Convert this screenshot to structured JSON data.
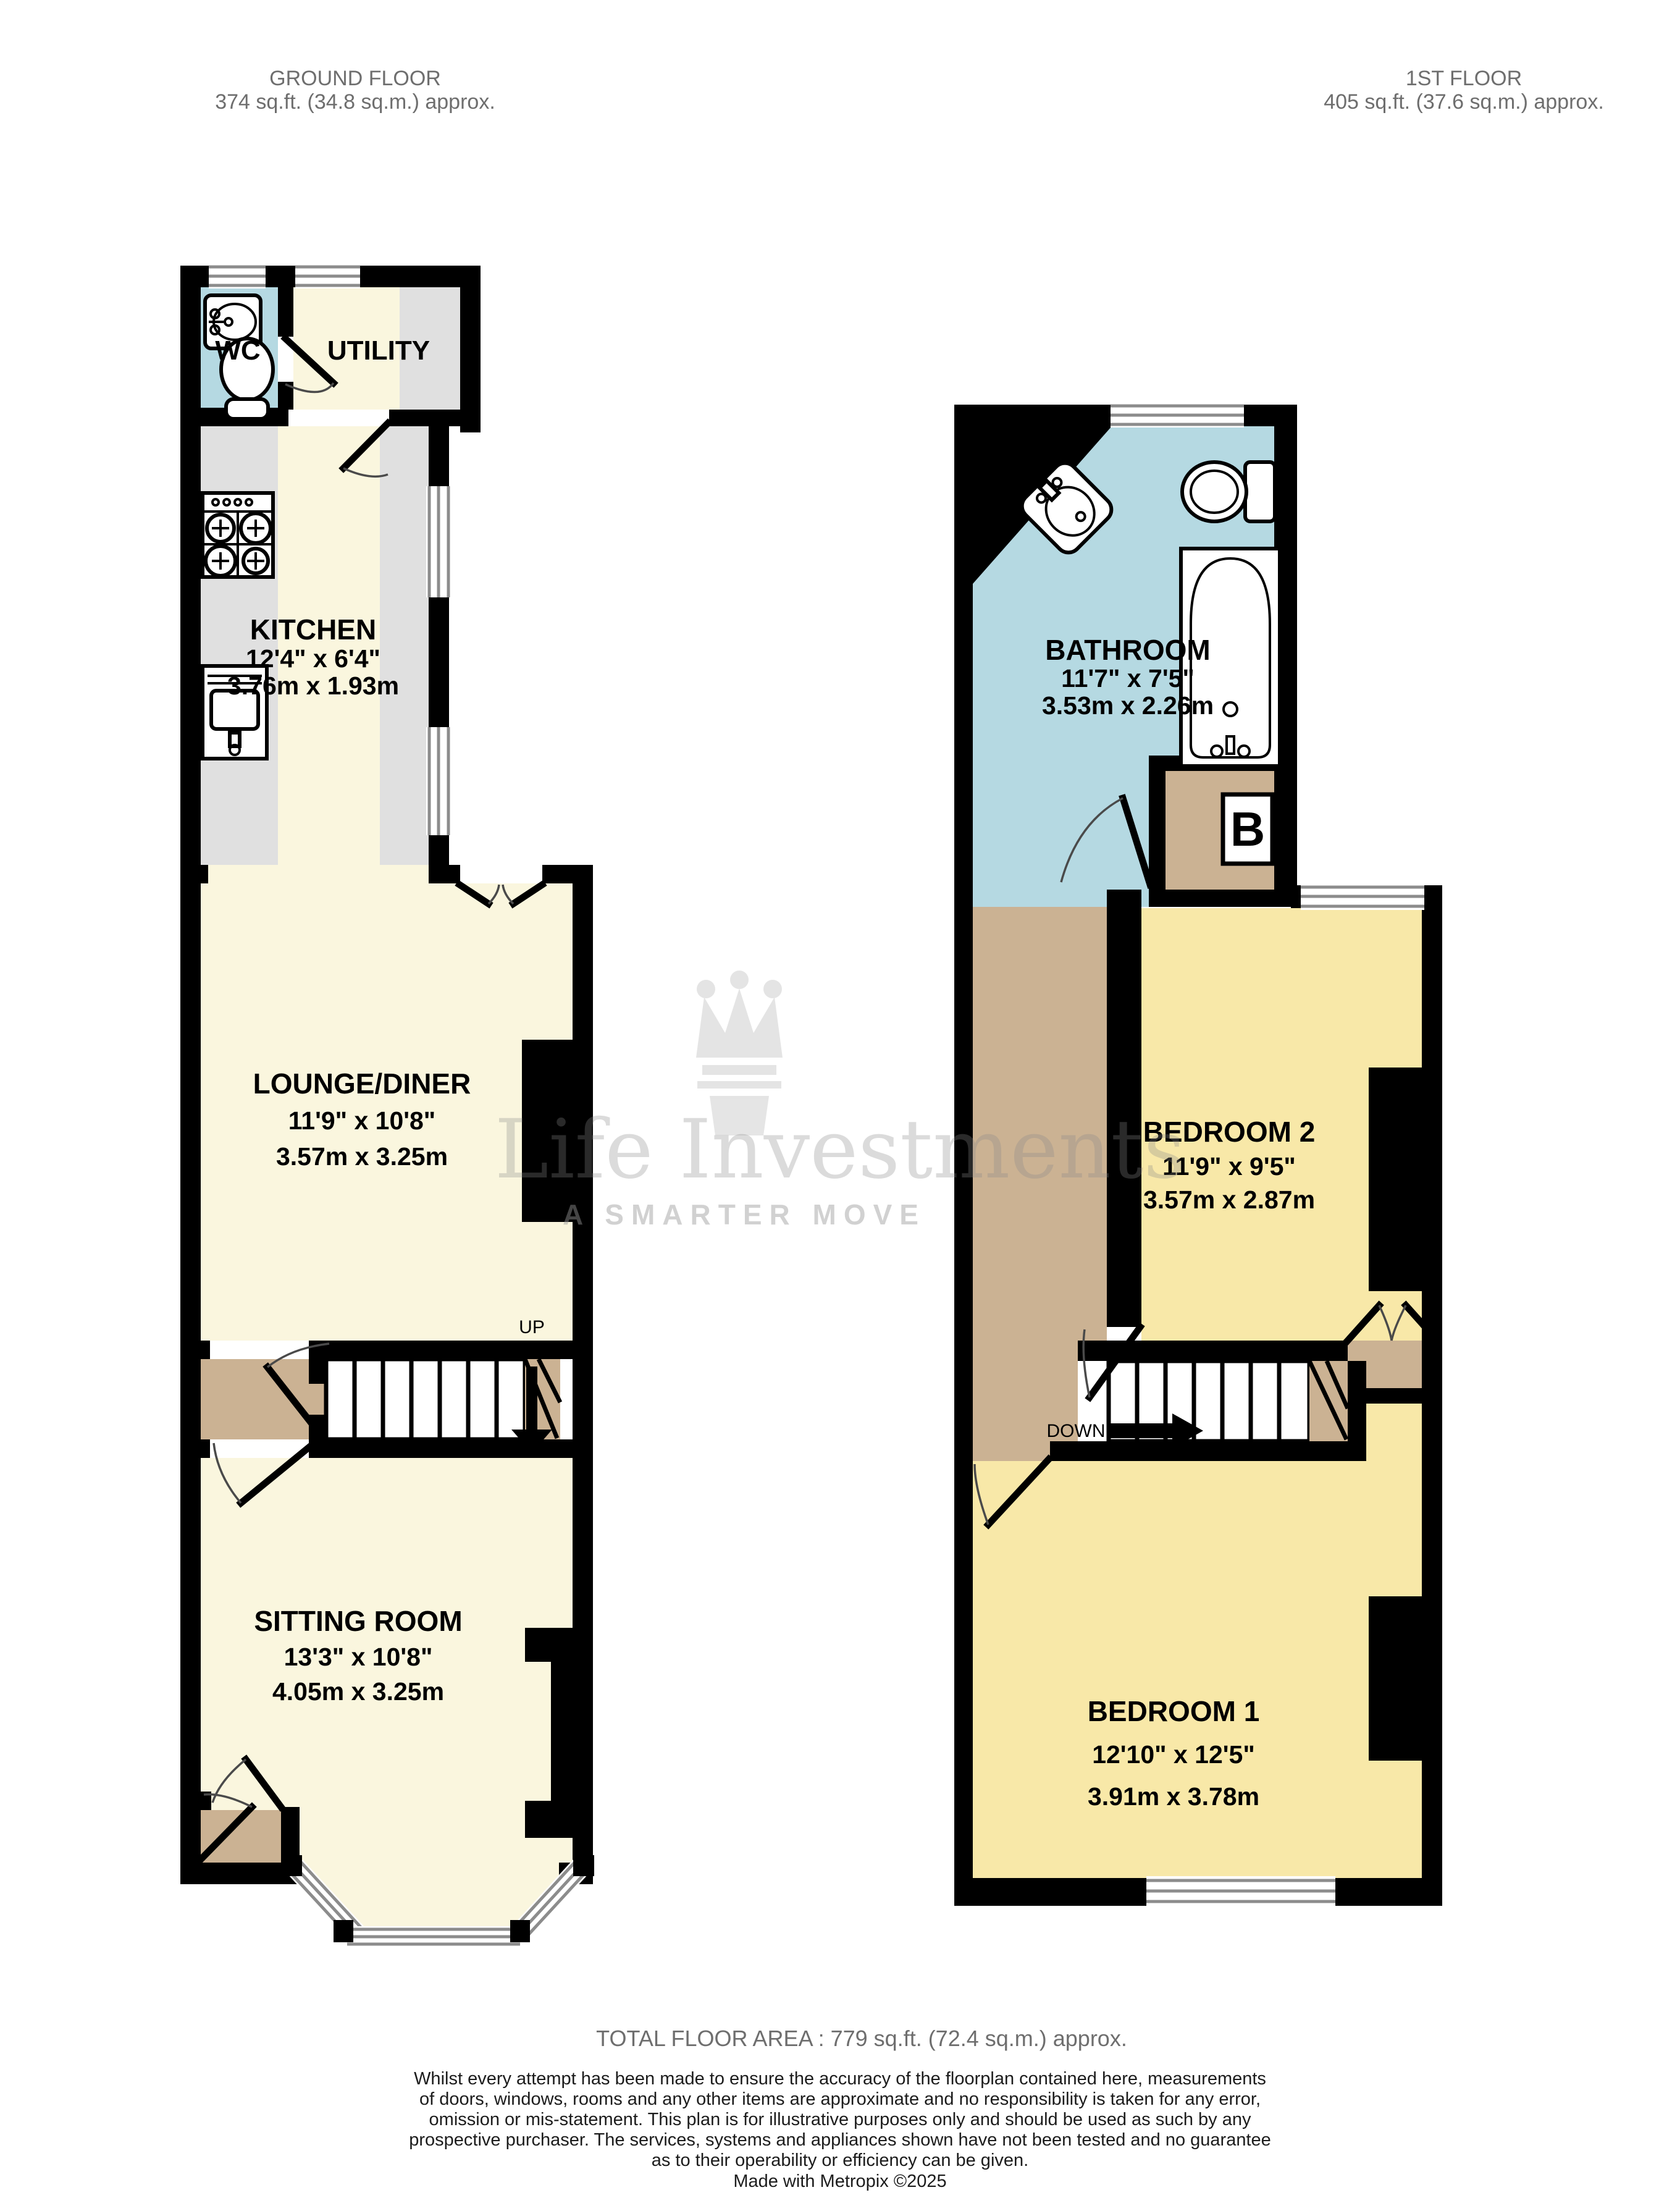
{
  "ground_floor": {
    "title": "GROUND FLOOR",
    "area": "374 sq.ft. (34.8 sq.m.) approx.",
    "stair_label": "UP",
    "rooms": {
      "wc": {
        "name": "WC"
      },
      "utility": {
        "name": "UTILITY"
      },
      "kitchen": {
        "name": "KITCHEN",
        "size_imperial": "12'4\" x 6'4\"",
        "size_metric": "3.76m x 1.93m"
      },
      "lounge_diner": {
        "name": "LOUNGE/DINER",
        "size_imperial": "11'9\" x 10'8\"",
        "size_metric": "3.57m x 3.25m"
      },
      "sitting_room": {
        "name": "SITTING ROOM",
        "size_imperial": "13'3\" x 10'8\"",
        "size_metric": "4.05m x 3.25m"
      }
    }
  },
  "first_floor": {
    "title": "1ST FLOOR",
    "area": "405 sq.ft. (37.6 sq.m.) approx.",
    "stair_label": "DOWN",
    "boiler_label": "B",
    "rooms": {
      "bathroom": {
        "name": "BATHROOM",
        "size_imperial": "11'7\" x 7'5\"",
        "size_metric": "3.53m x 2.26m"
      },
      "bedroom_2": {
        "name": "BEDROOM 2",
        "size_imperial": "11'9\" x 9'5\"",
        "size_metric": "3.57m x 2.87m"
      },
      "bedroom_1": {
        "name": "BEDROOM 1",
        "size_imperial": "12'10\" x 12'5\"",
        "size_metric": "3.91m x 3.78m"
      }
    }
  },
  "watermark": {
    "brand": "Life Investments",
    "tagline": "A SMARTER MOVE",
    "icon": "crown-icon"
  },
  "footer": {
    "total_area": "TOTAL FLOOR AREA : 779 sq.ft. (72.4 sq.m.) approx.",
    "disclaimer_lines": [
      "Whilst every attempt has been made to ensure the accuracy of the floorplan contained here, measurements",
      "of doors, windows, rooms and any other items are approximate and no responsibility is taken for any error,",
      "omission or mis-statement. This plan is for illustrative purposes only and should be used as such by any",
      "prospective purchaser. The services, systems and appliances shown have not been tested and no guarantee",
      "as to their operability or efficiency can be given."
    ],
    "credit": "Made with Metropix ©2025"
  },
  "colors": {
    "wall": "#000000",
    "floor_cream": "#faf6de",
    "floor_yellow": "#f8e8a8",
    "floor_blue": "#b5d9e2",
    "floor_tan": "#cbb293",
    "counter_grey": "#e0e0e0",
    "window_grey": "#8c8c8c",
    "header_text_grey": "#6e6e6e"
  }
}
